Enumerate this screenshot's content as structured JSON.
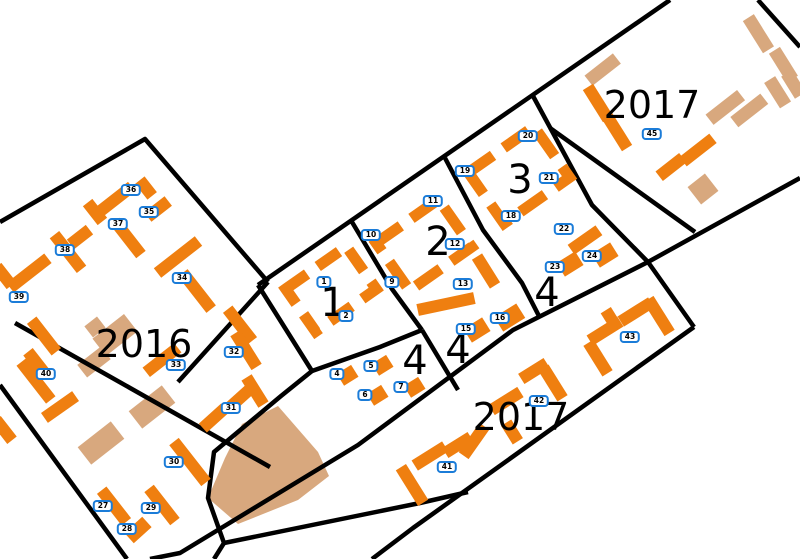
{
  "map": {
    "colors": {
      "planned": "#EF7F10",
      "existing": "#D8A87E",
      "badge_border": "#1B7CD8",
      "boundary": "#000000"
    },
    "badges": [
      {
        "n": "1",
        "x": 324,
        "y": 282
      },
      {
        "n": "2",
        "x": 346,
        "y": 316
      },
      {
        "n": "4",
        "x": 337,
        "y": 374
      },
      {
        "n": "5",
        "x": 371,
        "y": 366
      },
      {
        "n": "6",
        "x": 365,
        "y": 395
      },
      {
        "n": "7",
        "x": 401,
        "y": 387
      },
      {
        "n": "9",
        "x": 392,
        "y": 282
      },
      {
        "n": "10",
        "x": 371,
        "y": 235
      },
      {
        "n": "11",
        "x": 433,
        "y": 201
      },
      {
        "n": "12",
        "x": 455,
        "y": 244
      },
      {
        "n": "13",
        "x": 463,
        "y": 284
      },
      {
        "n": "15",
        "x": 466,
        "y": 329
      },
      {
        "n": "16",
        "x": 500,
        "y": 318
      },
      {
        "n": "18",
        "x": 511,
        "y": 216
      },
      {
        "n": "19",
        "x": 465,
        "y": 171
      },
      {
        "n": "20",
        "x": 528,
        "y": 136
      },
      {
        "n": "21",
        "x": 549,
        "y": 178
      },
      {
        "n": "22",
        "x": 564,
        "y": 229
      },
      {
        "n": "23",
        "x": 555,
        "y": 267
      },
      {
        "n": "24",
        "x": 592,
        "y": 256
      },
      {
        "n": "27",
        "x": 103,
        "y": 506
      },
      {
        "n": "28",
        "x": 127,
        "y": 529
      },
      {
        "n": "29",
        "x": 151,
        "y": 508
      },
      {
        "n": "30",
        "x": 174,
        "y": 462
      },
      {
        "n": "31",
        "x": 231,
        "y": 408
      },
      {
        "n": "32",
        "x": 234,
        "y": 352
      },
      {
        "n": "33",
        "x": 176,
        "y": 365
      },
      {
        "n": "34",
        "x": 182,
        "y": 278
      },
      {
        "n": "35",
        "x": 149,
        "y": 212
      },
      {
        "n": "36",
        "x": 131,
        "y": 190
      },
      {
        "n": "37",
        "x": 118,
        "y": 224
      },
      {
        "n": "38",
        "x": 65,
        "y": 250
      },
      {
        "n": "39",
        "x": 19,
        "y": 297
      },
      {
        "n": "40",
        "x": 46,
        "y": 374
      },
      {
        "n": "41",
        "x": 447,
        "y": 467
      },
      {
        "n": "42",
        "x": 539,
        "y": 401
      },
      {
        "n": "43",
        "x": 630,
        "y": 337
      },
      {
        "n": "45",
        "x": 652,
        "y": 134
      }
    ],
    "labels": [
      {
        "text": "2016",
        "x": 144,
        "y": 344,
        "size": 38
      },
      {
        "text": "2017",
        "x": 652,
        "y": 105,
        "size": 38
      },
      {
        "text": "2017",
        "x": 521,
        "y": 417,
        "size": 38
      },
      {
        "text": "1",
        "x": 333,
        "y": 303,
        "size": 40
      },
      {
        "text": "2",
        "x": 438,
        "y": 242,
        "size": 40
      },
      {
        "text": "3",
        "x": 520,
        "y": 180,
        "size": 40
      },
      {
        "text": "4",
        "x": 415,
        "y": 361,
        "size": 40
      },
      {
        "text": "4",
        "x": 458,
        "y": 350,
        "size": 40
      },
      {
        "text": "4",
        "x": 547,
        "y": 293,
        "size": 40
      }
    ]
  }
}
